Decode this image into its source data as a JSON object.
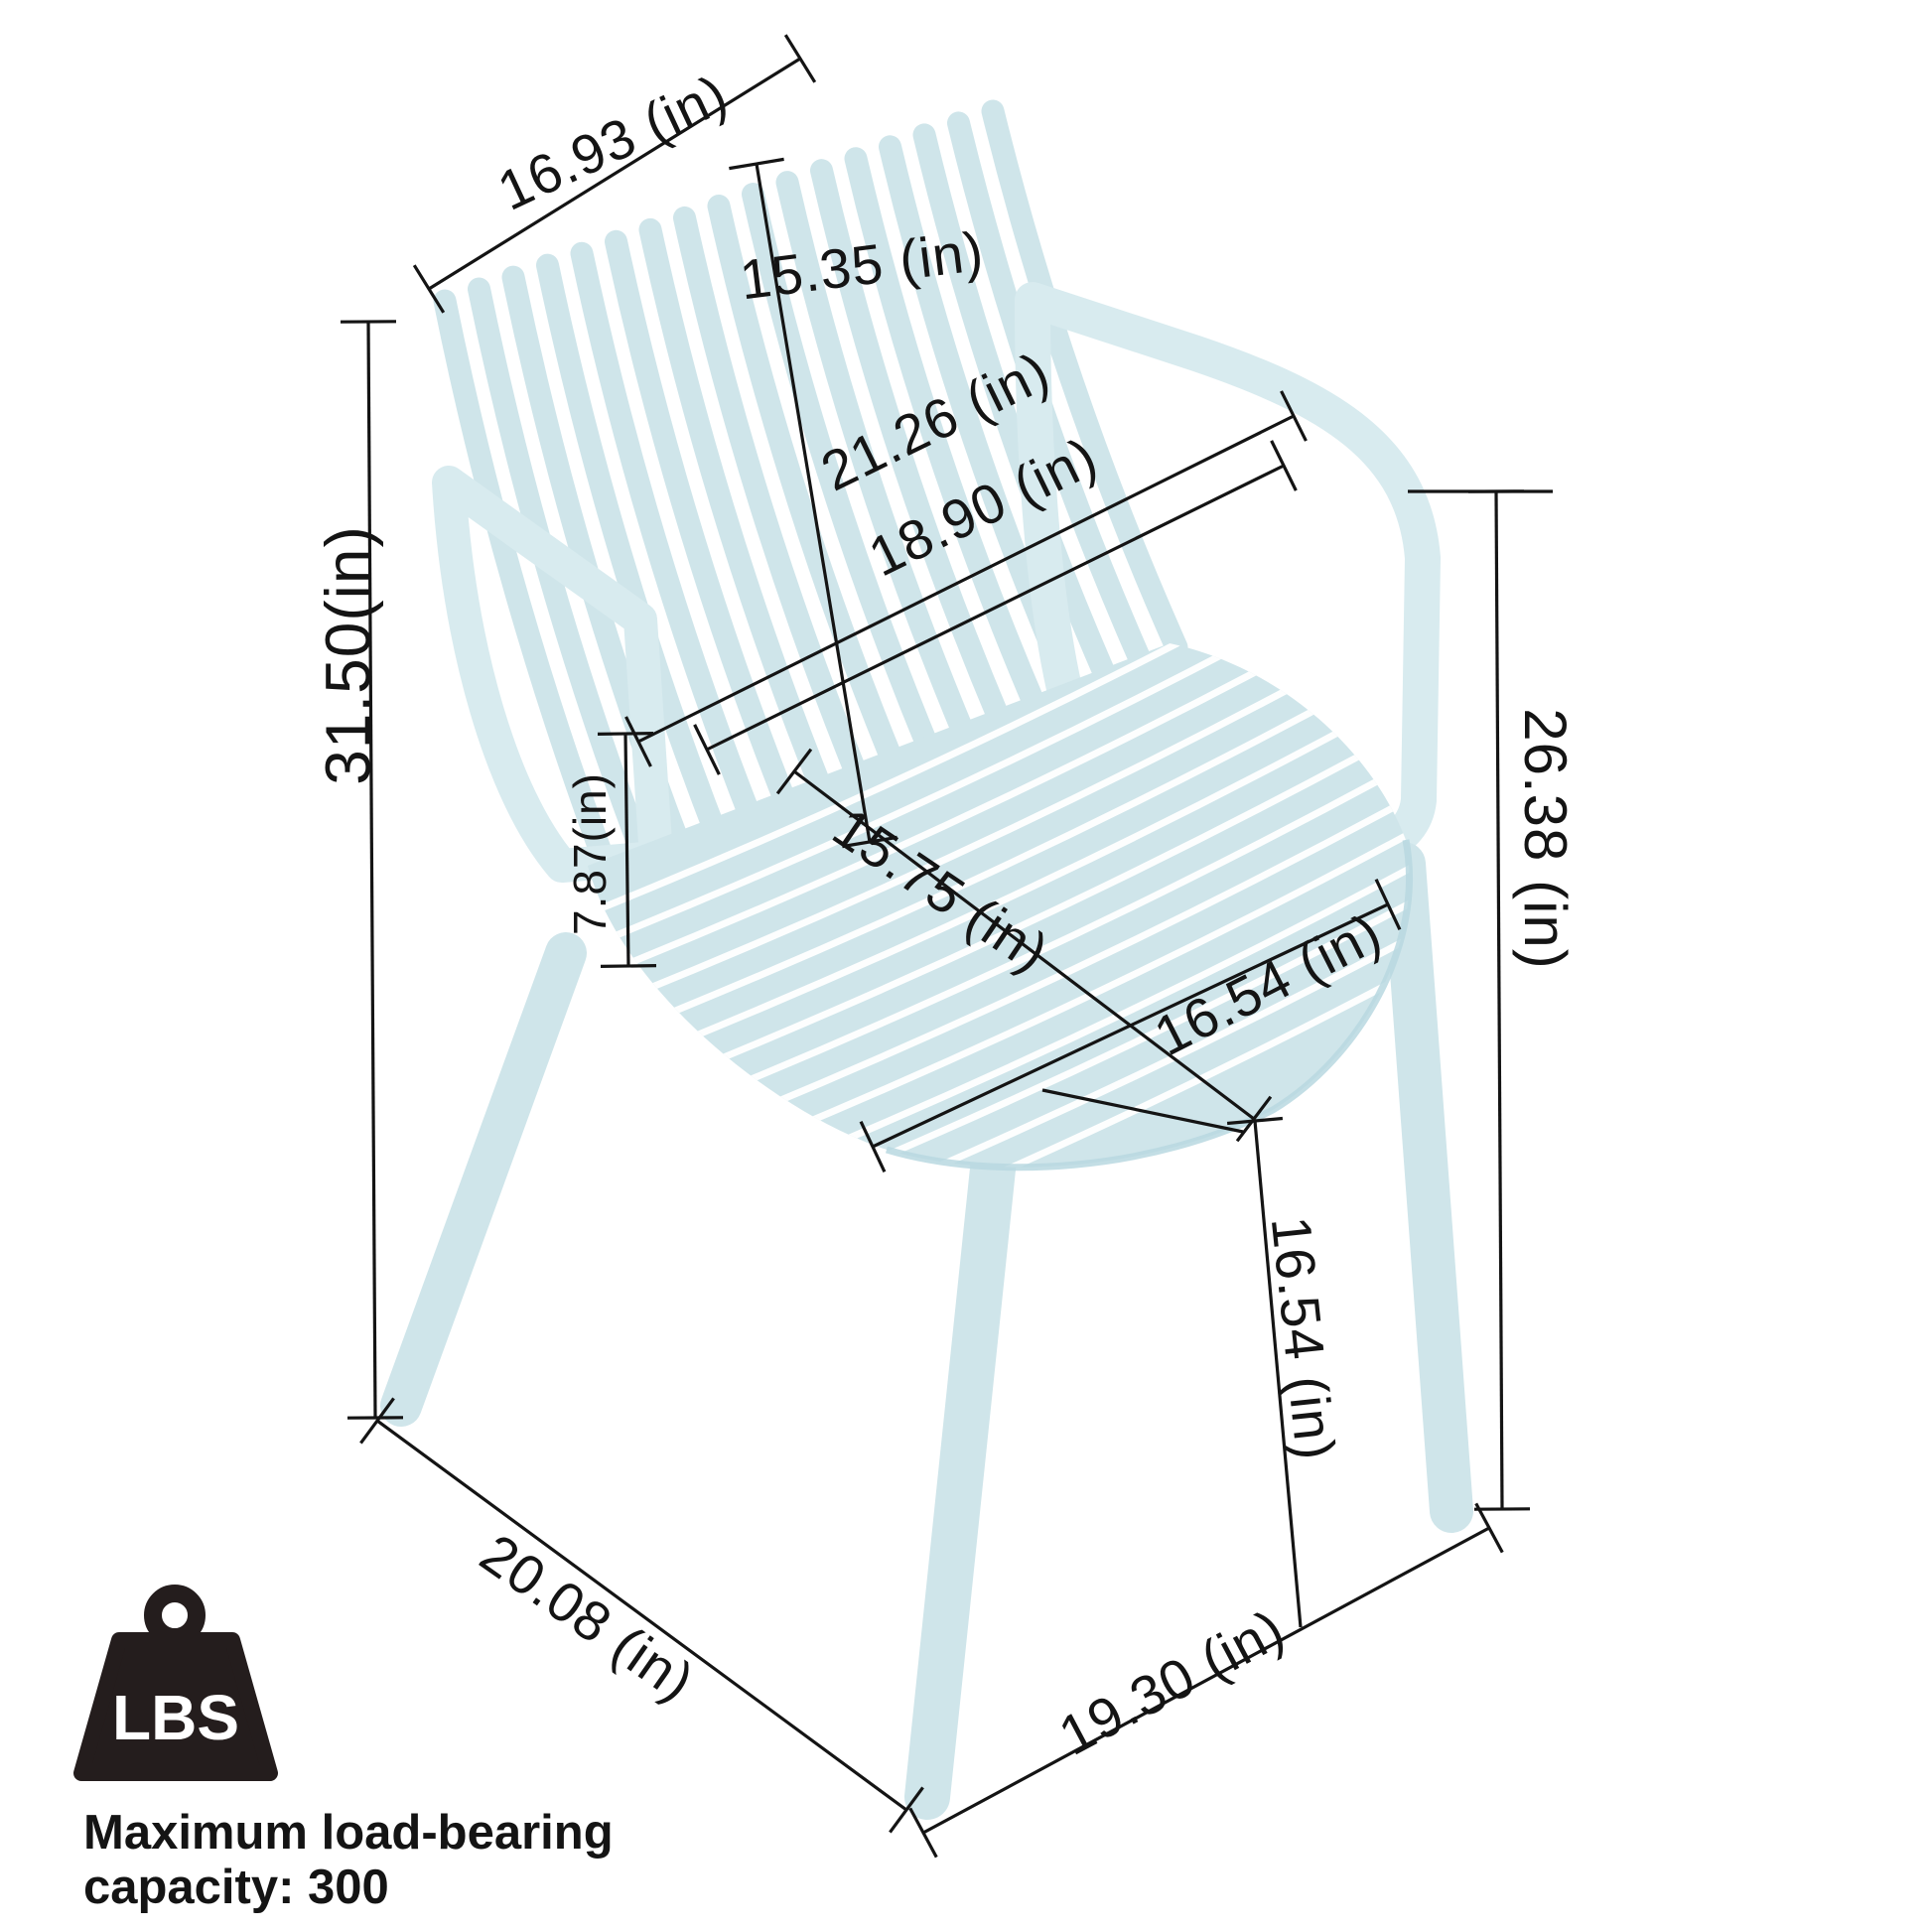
{
  "figure": {
    "type": "product-dimension-diagram",
    "product": "slatted plastic stacking armchair",
    "unit": "in"
  },
  "dimensions": {
    "back_top_width": {
      "label": "16.93 (in)",
      "value": 16.93
    },
    "backrest_height": {
      "label": "15.35 (in)",
      "value": 15.35
    },
    "overall_height": {
      "label": "31.50(in)",
      "value": 31.5
    },
    "armrest_above_seat": {
      "label": "7.87(in)",
      "value": 7.87
    },
    "overall_width": {
      "label": "21.26 (in)",
      "value": 21.26
    },
    "seat_back_width": {
      "label": "18.90 (in)",
      "value": 18.9
    },
    "seat_depth": {
      "label": "15.75 (in)",
      "value": 15.75
    },
    "seat_front_width": {
      "label": "16.54 (in)",
      "value": 16.54
    },
    "armrest_floor_height": {
      "label": "26.38 (in)",
      "value": 26.38
    },
    "seat_height": {
      "label": "16.54 (in)",
      "value": 16.54
    },
    "base_depth": {
      "label": "20.08 (in)",
      "value": 20.08
    },
    "base_width": {
      "label": "19.30 (in)",
      "value": 19.3
    }
  },
  "load_badge": {
    "unit_label": "LBS",
    "caption_line1": "Maximum load-bearing",
    "caption_line2": "capacity: 300",
    "capacity": 300
  },
  "colors": {
    "chair": "#cfe5ea",
    "chair_light": "#d8ebef",
    "chair_shade": "#b9d8e0",
    "line": "#141414",
    "text": "#141414",
    "badge": "#241d1d",
    "caption": "#2e2220"
  }
}
